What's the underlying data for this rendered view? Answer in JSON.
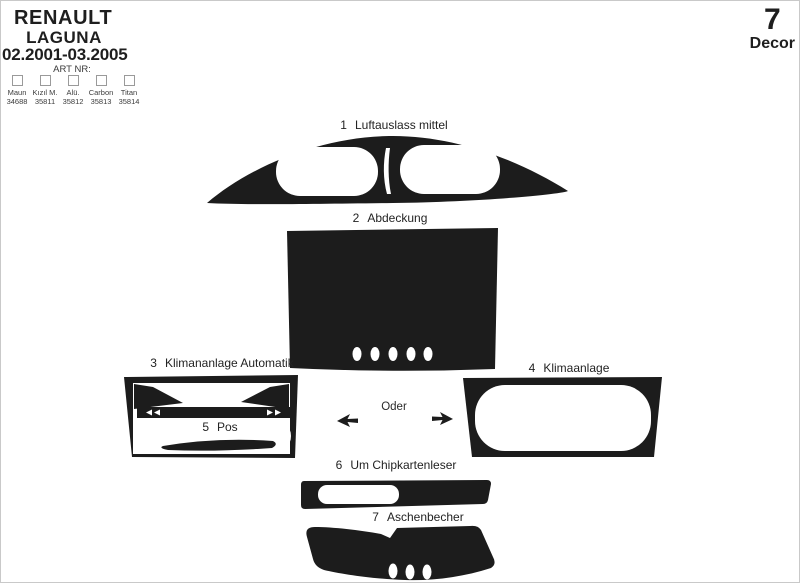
{
  "header": {
    "brand": "RENAULT",
    "model": "LAGUNA",
    "years": "02.2001-03.2005",
    "art_nr_label": "ART NR:",
    "finishes": [
      {
        "name": "Maun",
        "number": "34688"
      },
      {
        "name": "Kızıl M.",
        "number": "35811"
      },
      {
        "name": "Alü.",
        "number": "35812"
      },
      {
        "name": "Carbon",
        "number": "35813"
      },
      {
        "name": "Titan",
        "number": "35814"
      }
    ]
  },
  "badge": {
    "count": "7",
    "label": "Decor"
  },
  "diagram": {
    "or_label": "Oder",
    "ink_color": "#1c1c1c",
    "paper_color": "#ffffff",
    "parts": [
      {
        "num": "1",
        "label": "Luftauslass mittel"
      },
      {
        "num": "2",
        "label": "Abdeckung"
      },
      {
        "num": "3",
        "label": "Klimananlage Automatik"
      },
      {
        "num": "4",
        "label": "Klimaanlage"
      },
      {
        "num": "5",
        "label": "Pos"
      },
      {
        "num": "6",
        "label": "Um Chipkartenleser"
      },
      {
        "num": "7",
        "label": "Aschenbecher"
      }
    ]
  }
}
